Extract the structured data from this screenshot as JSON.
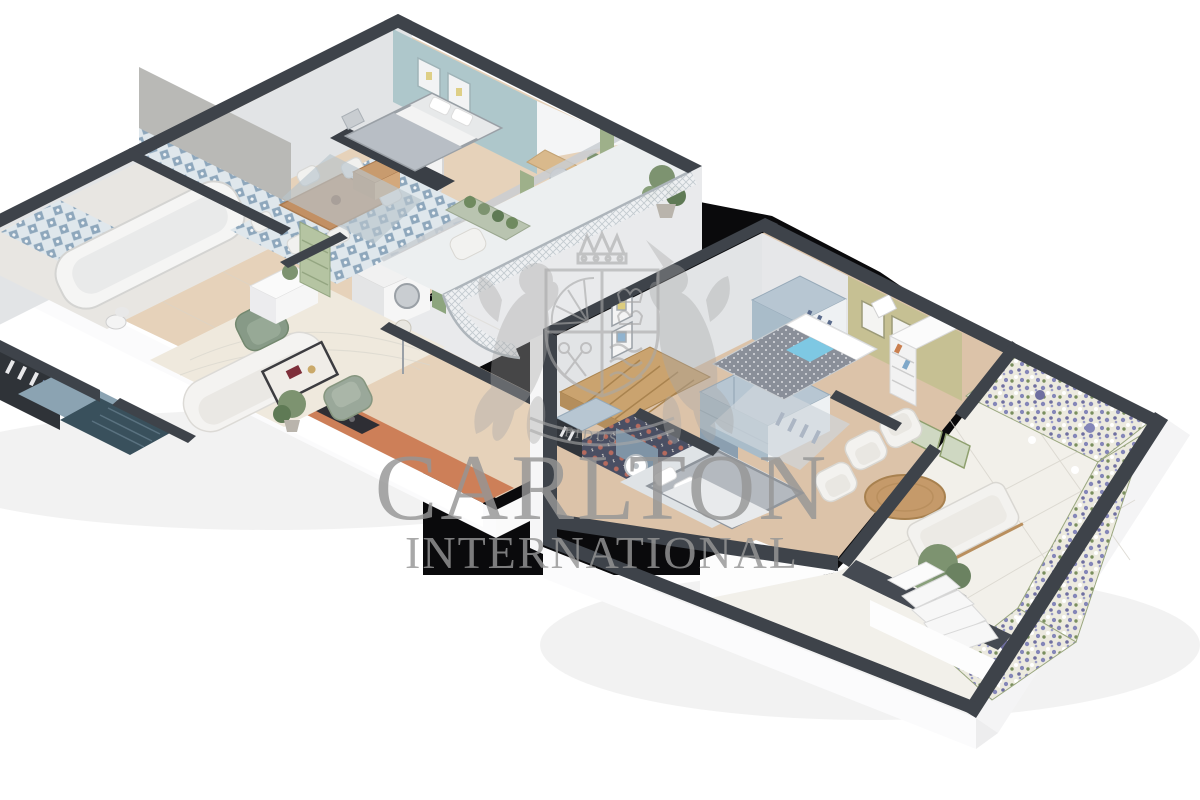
{
  "watermark": {
    "brand_line1": "CARLTON",
    "brand_line2": "INTERNATIONAL",
    "crest_motto": "FIDUS",
    "text_color": "#969696"
  },
  "palette": {
    "background": "#ffffff",
    "backdrop_black": "#0a0a0c",
    "wall_dark": "#3e434a",
    "wall_light_face": "#e2e4e6",
    "floor_wood": "#e6d2ba",
    "accent_teal_wall": "#aec7cb",
    "accent_olive_wall": "#c6c093",
    "kitchen_counter_terracotta": "#cd7f58",
    "tile_blue": "#8ea7bc",
    "cabinet_blue_gray": "#a9bcc9",
    "terrace_stone": "#f2f0ea",
    "lavender_flowers": "#8486b8",
    "plant_green": "#7d9370",
    "armchair_green": "#879a87"
  }
}
